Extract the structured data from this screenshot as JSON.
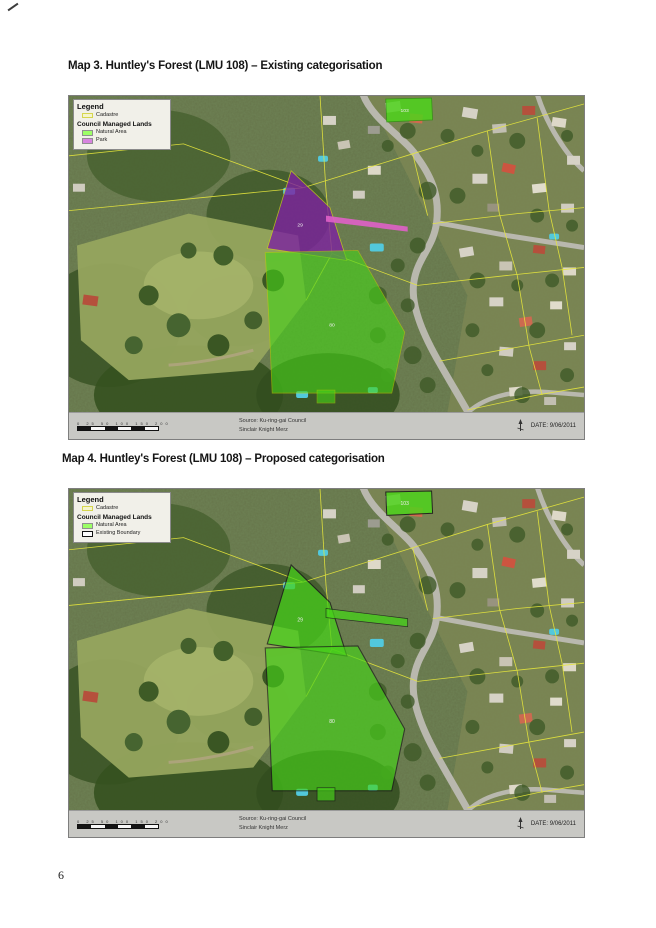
{
  "page": {
    "number": "6"
  },
  "colors": {
    "natural_area_fill": "#46d319",
    "park_fill": "#7d22a0",
    "park_strip": "#e060c8",
    "cadastre_line": "#e6e63c",
    "legend_natural_swatch": "#9cff66",
    "legend_park_swatch": "#d884e0",
    "existing_boundary": "#161616",
    "footer_bar": "#c8c8c4"
  },
  "maps": [
    {
      "title_bold": "Map 3.",
      "title_rest": " Huntley's Forest (LMU 108) – Existing categorisation",
      "legend": {
        "title": "Legend",
        "cadastre_label": "Cadastre",
        "group_label": "Council Managed Lands",
        "natural_label": "Natural Area",
        "park_label": "Park"
      },
      "parcel_labels": {
        "top": "103",
        "triangle": "29",
        "big": "80"
      },
      "footer": {
        "scale_ticks": "0 25 50 100 150 200",
        "source_line1": "Source: Ku-ring-gai Council",
        "source_line2": "Sinclair Knight Merz",
        "date": "DATE: 9/06/2011"
      }
    },
    {
      "title_bold": "Map 4.",
      "title_rest": " Huntley's Forest (LMU 108) – Proposed categorisation",
      "legend": {
        "title": "Legend",
        "cadastre_label": "Cadastre",
        "group_label": "Council Managed Lands",
        "natural_label": "Natural Area",
        "boundary_label": "Existing Boundary"
      },
      "parcel_labels": {
        "top": "103",
        "triangle": "29",
        "big": "80"
      },
      "footer": {
        "scale_ticks": "0 25 50 100 150 200",
        "source_line1": "Source: Ku-ring-gai Council",
        "source_line2": "Sinclair Knight Merz",
        "date": "DATE: 9/06/2011"
      }
    }
  ]
}
